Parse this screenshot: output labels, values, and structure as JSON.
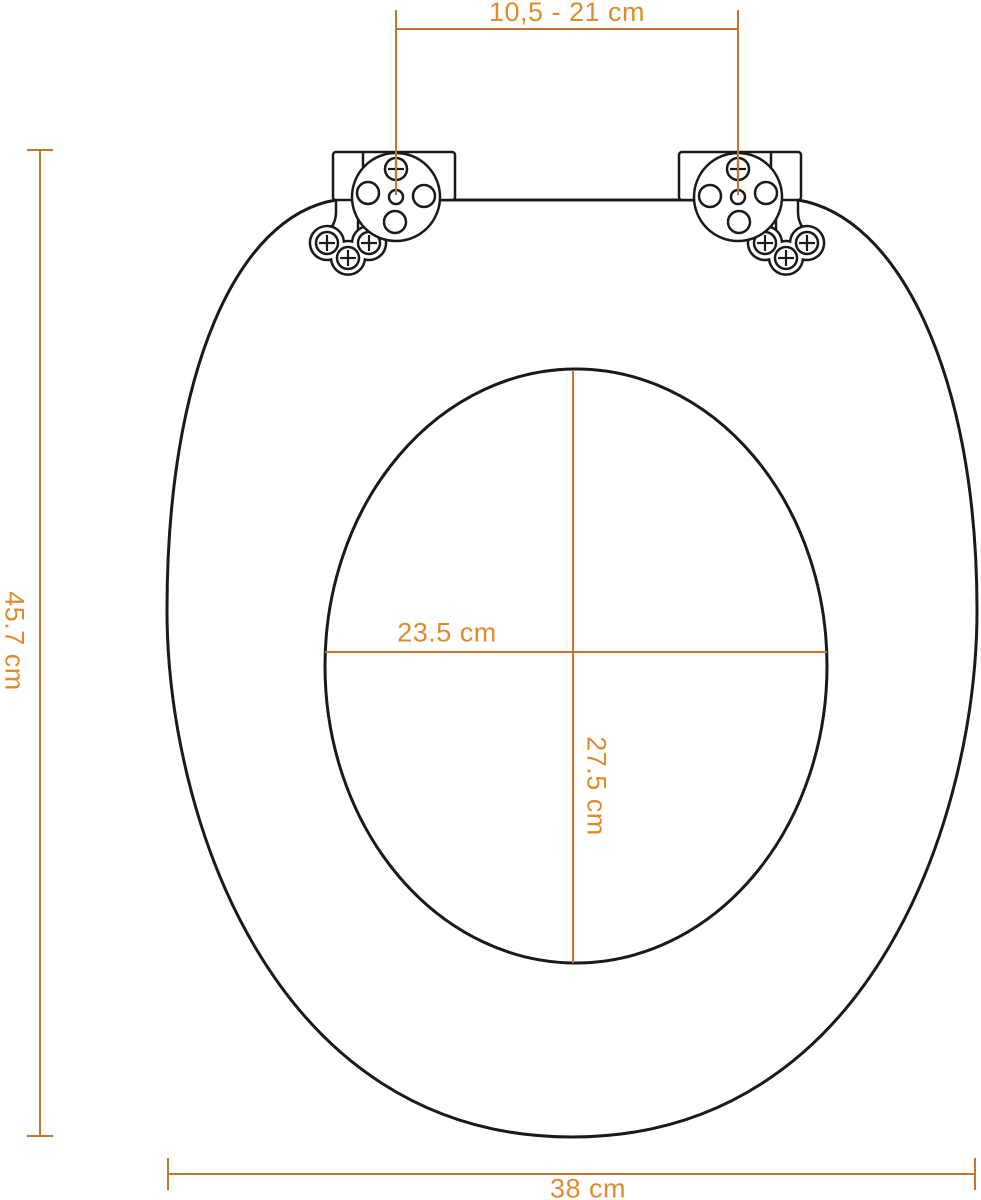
{
  "diagram": {
    "type": "toilet-seat-dimension-diagram",
    "labels": {
      "hinge_distance": "10,5 - 21 cm",
      "overall_length": "45.7 cm",
      "hole_width": "23.5 cm",
      "hole_length": "27.5 cm",
      "overall_width": "38 cm"
    },
    "colors": {
      "dimension_text": "#DE8C2C",
      "dimension_line": "#C4752F",
      "seat_outline": "#1A1A1A",
      "background": "#FFFFFF"
    }
  }
}
